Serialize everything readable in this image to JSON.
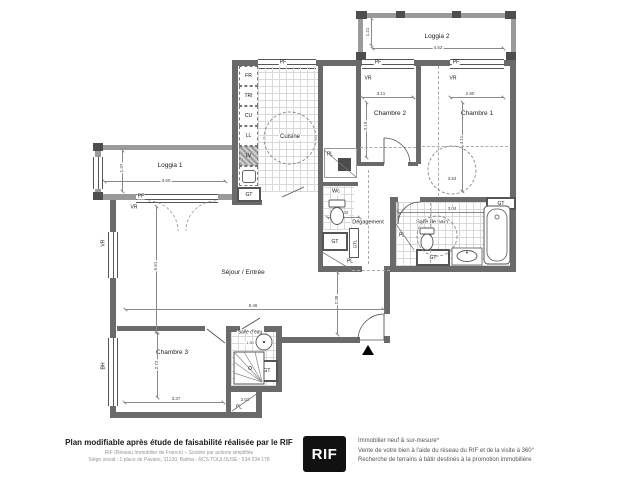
{
  "plan": {
    "rooms": {
      "loggia2": "Loggia 2",
      "chambre2": "Chambre 2",
      "chambre1": "Chambre 1",
      "loggia1": "Loggia 1",
      "cuisine": "Cuisine",
      "sejour": "Séjour / Entrée",
      "chambre3": "Chambre 3",
      "salle_deau": "Salle d'eau",
      "degagement": "Dégagement",
      "salle_de_bain": "Salle de bain",
      "wc": "Wc"
    },
    "tags": {
      "fr": "FR",
      "tri": "TRI",
      "cu": "CU",
      "ll": "LL",
      "lv": "LV",
      "gt": "GT",
      "gtl": "GTL",
      "pl": "PL",
      "pf": "PF",
      "vr": "VR",
      "bh": "BH"
    },
    "dims": {
      "loggia2_w": "4.52",
      "loggia2_h": "1.21",
      "ch2_w": "3.11",
      "ch2_h": "3.19",
      "ch1_w": "2.80",
      "ch1_h": "4.11",
      "ch1_h2": "3.54",
      "loggia1_w": "3.60",
      "loggia1_h": "1.37",
      "sejour_w": "8.46",
      "sejour_h": "5.61",
      "sejour_h2": "2.38",
      "deg_w": "1.42",
      "ch3_w": "3.37",
      "ch3_h": "2.72",
      "ch3_pl": "2.02",
      "sde_w": "1.50",
      "sdb_w": "3.04"
    }
  },
  "footer": {
    "headline": "Plan modifiable après étude de faisabilité réalisée par le RIF",
    "line1": "RIF (Réseau Immobilier de France) – Société par actions simplifiée",
    "line2": "Siège social : 1 place de Pavans, 31130, Balma - RCS TOULOUSE : 534 234 178",
    "logo": "RIF",
    "brand_black": "#111111",
    "services": [
      "Immobilier neuf & sur-mesure*",
      "Vente de votre bien à l'aide du réseau du RIF et de la visite à 360°",
      "Recherche de terrains à bâtir destinés à la promotion immobilière"
    ]
  }
}
